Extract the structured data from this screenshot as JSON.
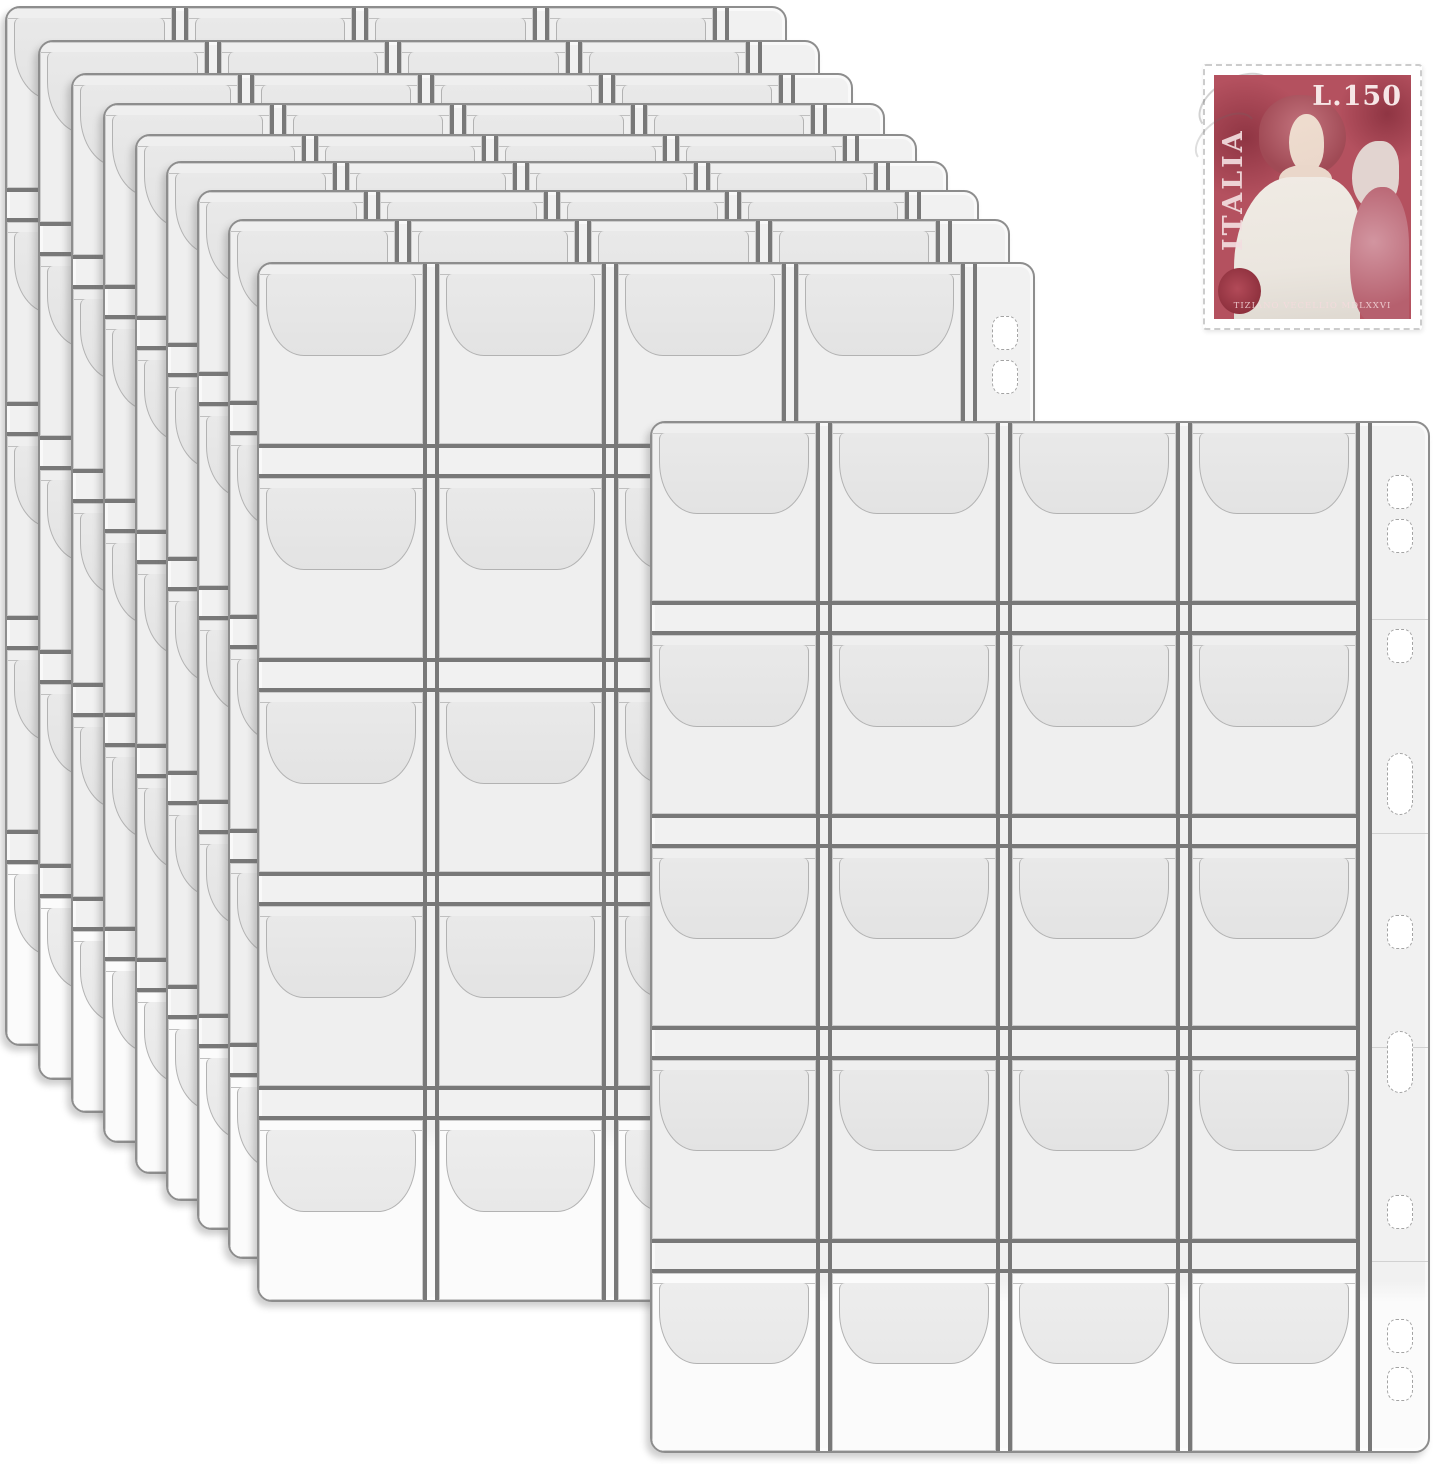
{
  "scene": {
    "background_color": "#ffffff"
  },
  "pocket_pages": {
    "count": 10,
    "grid_columns": 4,
    "grid_rows": 5,
    "pockets_per_page": 20,
    "pages": [
      {
        "left": 5,
        "top": 6,
        "width": 782,
        "height": 1040
      },
      {
        "left": 38,
        "top": 40,
        "width": 782,
        "height": 1040
      },
      {
        "left": 71,
        "top": 73,
        "width": 782,
        "height": 1040
      },
      {
        "left": 103,
        "top": 103,
        "width": 782,
        "height": 1040
      },
      {
        "left": 135,
        "top": 134,
        "width": 782,
        "height": 1040
      },
      {
        "left": 166,
        "top": 161,
        "width": 782,
        "height": 1040
      },
      {
        "left": 197,
        "top": 190,
        "width": 782,
        "height": 1040
      },
      {
        "left": 228,
        "top": 219,
        "width": 782,
        "height": 1040
      },
      {
        "left": 257,
        "top": 262,
        "width": 778,
        "height": 1040
      },
      {
        "left": 650,
        "top": 421,
        "width": 780,
        "height": 1032
      }
    ],
    "holes": [
      {
        "shape": "hex",
        "y": 52
      },
      {
        "shape": "hex",
        "y": 96
      },
      {
        "shape": "hex",
        "y": 206
      },
      {
        "shape": "slot",
        "y": 330,
        "h": 62
      },
      {
        "shape": "hex",
        "y": 492
      },
      {
        "shape": "slot",
        "y": 608,
        "h": 62
      },
      {
        "shape": "hex",
        "y": 772
      },
      {
        "shape": "hex",
        "y": 896
      },
      {
        "shape": "hex",
        "y": 944
      }
    ],
    "strip_seams": [
      196,
      410,
      624,
      838
    ]
  },
  "stamp": {
    "country": "ITALIA",
    "denomination": "L.150",
    "caption": "TIZIANO VECELLIO MDLXXVI"
  },
  "colors": {
    "page_fill": "#f1f1f1",
    "page_fill_bottom": "#fbfbfb",
    "page_border": "#8d8d8d",
    "divider": "#787878",
    "pocket_fill": "#efefef",
    "pocket_fill_last": "#fbfbfb",
    "pocket_edge": "#cccccc",
    "flap_fill": "#e9e9e9",
    "flap_edge": "#b2b2b2",
    "hole_edge": "#a3a3a3",
    "stamp_paper": "#ffffff",
    "stamp_ink": "#b4515f",
    "stamp_ink_dark": "#8f3543",
    "stamp_skin": "#ead7ca",
    "stamp_robe": "#ebe6df",
    "stamp_drape": "#d295a0",
    "stamp_text": "#f3dee0"
  }
}
